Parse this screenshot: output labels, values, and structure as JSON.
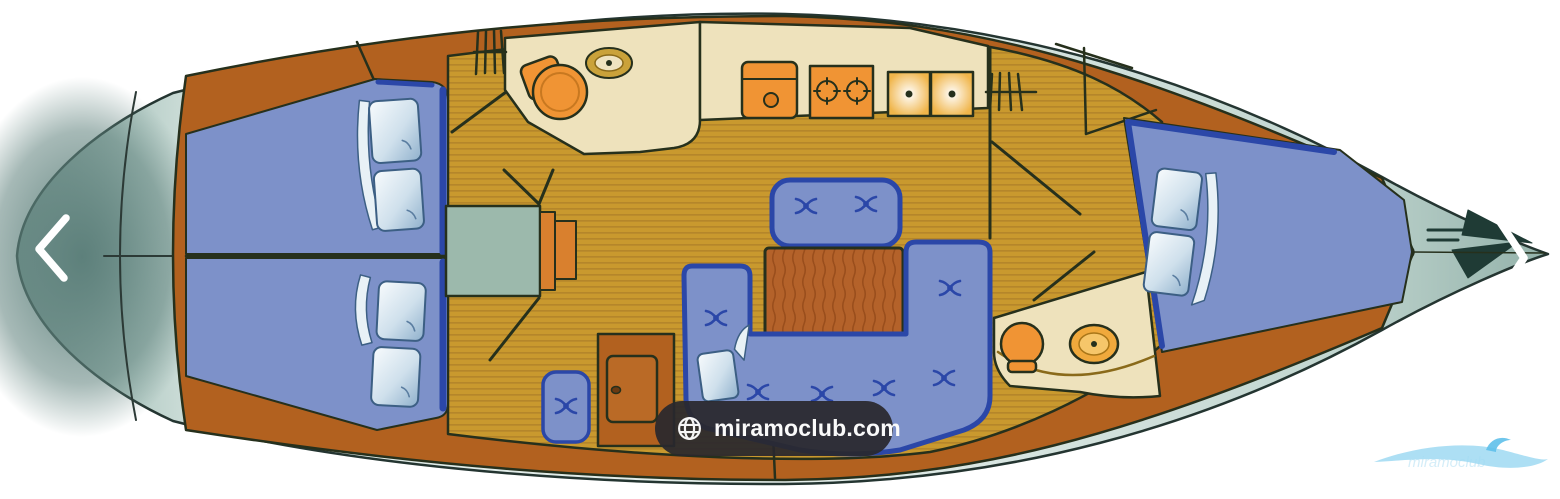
{
  "viewer": {
    "background_color": "#ffffff",
    "prev_button": {
      "icon": "chevron-left",
      "color": "#ffffff"
    },
    "next_button": {
      "icon": "chevron-right",
      "color": "#ffffff"
    },
    "watermark_badge": {
      "icon": "globe",
      "label": "miramoclub.com",
      "background": "#29282d",
      "text_color": "#fafafa"
    },
    "corner_logo": {
      "name": "wave-swoosh-logo",
      "text": "miramoclub",
      "color": "#9fd9f2"
    }
  },
  "diagram": {
    "title": "sailboat-interior-layout-plan",
    "orientation": "bow-right",
    "areas": [
      {
        "name": "stern-deck"
      },
      {
        "name": "aft-cabin-port",
        "furniture": "double-berth-with-two-pillows"
      },
      {
        "name": "aft-cabin-starboard",
        "furniture": "double-berth-with-two-pillows"
      },
      {
        "name": "companionway-steps-engine-box"
      },
      {
        "name": "wardrobe-cabinet"
      },
      {
        "name": "stool-seat"
      },
      {
        "name": "head-aft",
        "furniture": "toilet-and-sink"
      },
      {
        "name": "galley",
        "furniture": "icebox, two-burner-stove, double-sink, locker"
      },
      {
        "name": "saloon",
        "furniture": "u-shaped-sofa, table, island-bench, pillow"
      },
      {
        "name": "head-forward",
        "furniture": "toilet-and-sink"
      },
      {
        "name": "forward-cabin",
        "furniture": "v-berth-with-two-pillows"
      },
      {
        "name": "bow-deck",
        "furniture": "anchor"
      }
    ],
    "colors": {
      "wood": "#b2611f",
      "floor": "#c9992e",
      "floor_stripe": "#b5862a",
      "upholstery": "#7d91c9",
      "upholstery_border": "#2b47a8",
      "cream": "#eee2bc",
      "fixture_orange": "#f09434",
      "hull_gray": "#8ba59f",
      "outline": "#26301c",
      "pillow": "#dcebf5"
    }
  }
}
